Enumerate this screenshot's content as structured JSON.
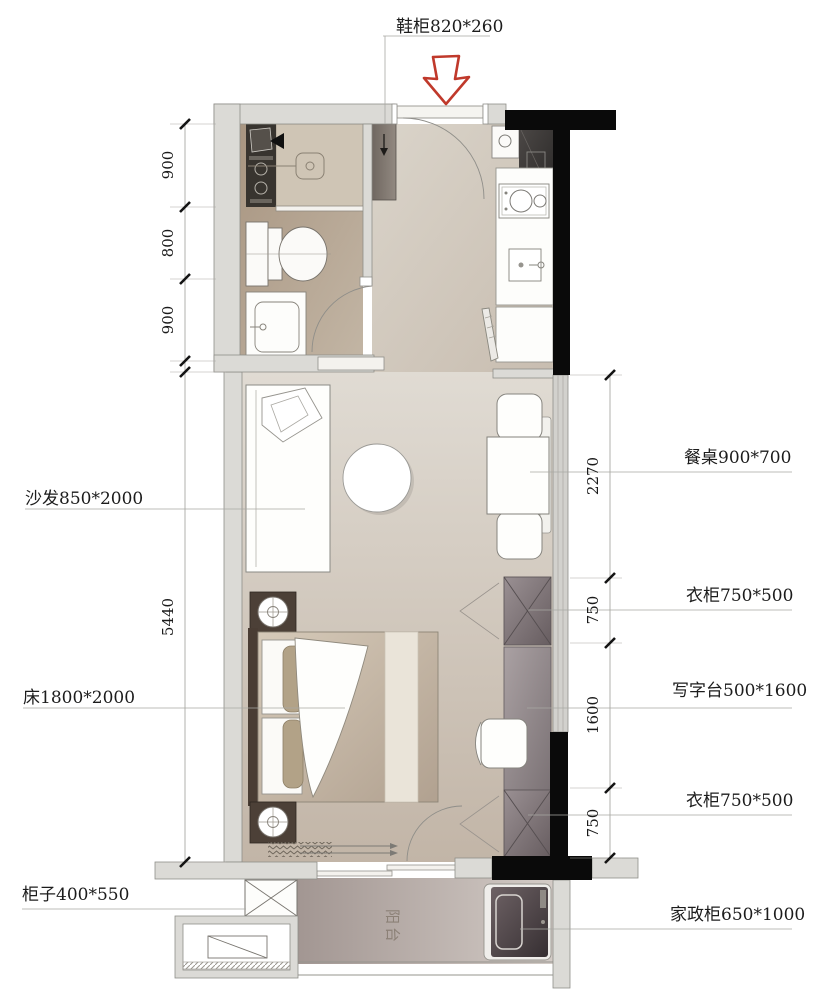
{
  "drawing": {
    "type": "apartment-floor-plan",
    "labels": {
      "shoe_cabinet": "鞋柜820*260",
      "dining_table": "餐桌900*700",
      "wardrobe_top": "衣柜750*500",
      "desk": "写字台500*1600",
      "wardrobe_bottom": "衣柜750*500",
      "housekeeping_cabinet": "家政柜650*1000",
      "sofa": "沙发850*2000",
      "bed": "床1800*2000",
      "cabinet": "柜子400*550",
      "balcony": "阳台"
    },
    "dimensions": {
      "left": [
        "900",
        "800",
        "900",
        "5440"
      ],
      "right": [
        "2270",
        "750",
        "1600",
        "750"
      ]
    },
    "colors": {
      "entry_arrow_red": "#c0392b",
      "structural_wall": "#0a0a0a",
      "partition_wall": "#dbdad6",
      "wardrobe_grey": "#7c7376",
      "floor_beige": "#c9bcae"
    }
  }
}
